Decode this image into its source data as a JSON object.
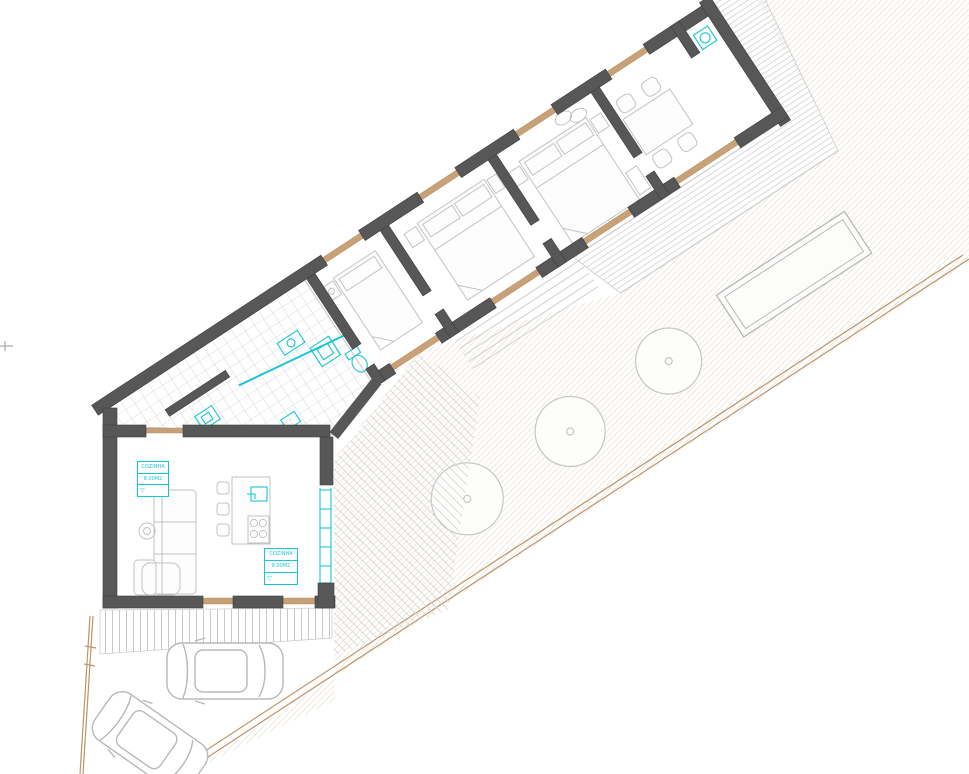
{
  "drawing": {
    "kind": "architectural floor plan / site plan, rotated building",
    "labels": {
      "box1": {
        "room": "COZINHA",
        "area": "8.00M2",
        "level_marker": "▽"
      },
      "box2": {
        "room": "COZINHA",
        "area": "9.00M2",
        "level_marker": "▽"
      }
    },
    "site": {
      "trees": 3,
      "parked_cars": 2,
      "pools": 1
    },
    "colors": {
      "wall": "#575757",
      "fixtures_cyan": "#19c5d5",
      "wood_sill_tan": "#c8a178",
      "site_boundary_tan": "#bf9468",
      "furniture_gray": "#c3c3c3",
      "tile_grid_gray": "#b6bcc4",
      "deck_stripe_gray": "#d9d9d9"
    }
  }
}
